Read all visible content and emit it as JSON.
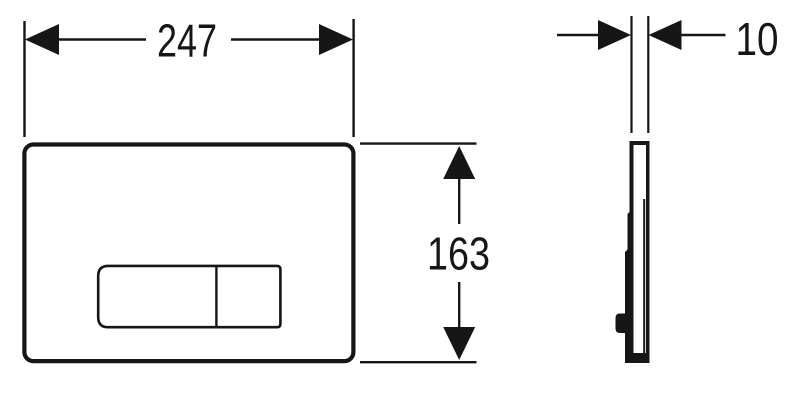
{
  "drawing": {
    "background_color": "#ffffff",
    "line_color": "#161616",
    "dimensions": {
      "width": "247",
      "height": "163",
      "depth": "10"
    }
  }
}
